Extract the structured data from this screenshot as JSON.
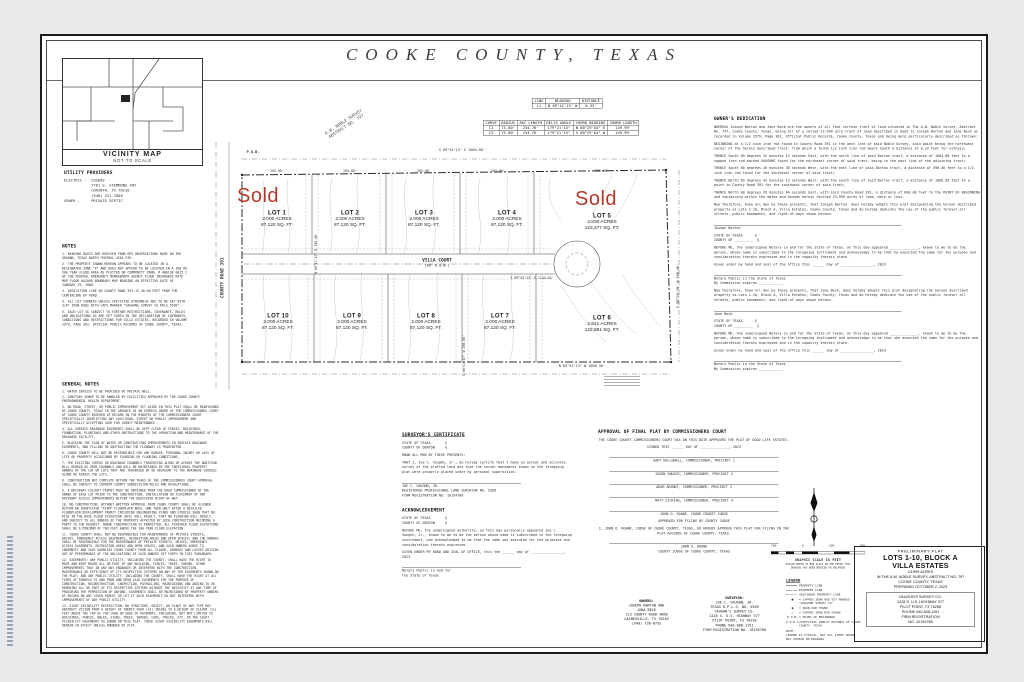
{
  "sheet": {
    "title": "COOKE  COUNTY,  TEXAS"
  },
  "vicinity": {
    "title": "VICINITY MAP",
    "subtitle": "NOT TO SCALE"
  },
  "utilities": {
    "title": "UTILITY PROVIDERS",
    "lines": [
      "ELECTRIC -  COSERV",
      "            7701 S. STEMMONS FWY",
      "            CORINTH, TX 76210",
      "            (940) 321-7800",
      "",
      "SEWER -     PRIVATE SEPTIC"
    ]
  },
  "notes": {
    "title": "NOTES",
    "items": [
      "1. BEARING BASIS ARE DERIVED FROM GPS OBSERVATIONS MADE ON THE GROUND, TEXAS NORTH CENTRAL 4202 RTK.",
      "2. THE PROPERTY SHOWN HEREON APPEARS TO BE LOCATED IN A DESIGNATED ZONE \"X\" AND DOES NOT APPEAR TO BE LOCATED IN A 100 OR 500 YEAR FLOOD AREA AS PLOTTED ON COMMUNITY PANEL # 480198 0025 C OF THE FEDERAL EMERGENCY MANAGEMENT AGENCY FLOOD INSURANCE RATE MAP FLOOD HAZARD BOUNDARY MAP BEARING AN EFFECTIVE DATE OF JANUARY 19, 2006.",
      "3. DEDICATION LINE ON COUNTY ROAD 391 IS 30.00 FEET FROM THE CENTERLINE OF ROAD.",
      "4. ALL LOT CORNERS UNLESS SPECIFIED OTHERWISE ARE TO BE SET WITH 3/8\" IRON RODS WITH CAPS MARKED \"VAUGHNS SURVEY CO RPLS 5509\".",
      "5. EACH LOT IS SUBJECT TO FURTHER RESTRICTIONS, COVENANTS, RULES AND OBLIGATIONS AS ARE SET FORTH IN THE DECLARATION OF COVENANTS, CONDITIONS AND RESTRICTIONS FOR VILLA ESTATES, RECORDED IN VOLUME 2979, PAGE 362, OFFICIAL PUBLIC RECORDS OF COOKE COUNTY, TEXAS."
    ]
  },
  "general_notes": {
    "title": "GENERAL NOTES",
    "items": [
      "1. WATER SERVICE TO BE PROVIDED BY PRIVATE WELL.",
      "2. SANITARY SEWER TO BE HANDLED BY FACILITIES APPROVED BY THE COOKE COUNTY ENVIRONMENTAL HEALTH DEPARTMENT.",
      "3. NO ROAD, STREET, OR PUBLIC IMPROVEMENT SET ASIDE IN THIS PLAT SHALL BE MAINTAINED BY COOKE COUNTY, TEXAS IN THE ABSENCE OF AN EXPRESS ORDER OF THE COMMISSIONERS COURT OF COOKE COUNTY ENTERED OF RECORD IN THE MINUTES OF THE COMMISSIONERS COURT SPECIFICALLY IDENTIFYING ANY SUCH ROAD, STREET OR PUBLIC IMPROVEMENT AND SPECIFICALLY ACCEPTING SUCH FOR COUNTY MAINTENANCE.",
      "4. ALL SURFACE DRAINAGE EASEMENTS SHALL BE KEPT CLEAR OF FENCES, BUILDINGS, FOUNDATION, PLANTINGS AND OTHER OBSTRUCTIONS TO THE OPERATION AND MAINTENANCE OF THE DRAINAGE FACILITY.",
      "5. BLOCKING THE FLOW OF WATER OR CONSTRUCTING IMPROVEMENTS IN SURFACE DRAINAGE EASEMENTS, AND FILLING OR OBSTRUCTING THE FLOODWAY IS PROHIBITED.",
      "6. COOKE COUNTY WILL NOT BE RESPONSIBLE FOR ANY DAMAGE, PERSONAL INJURY OR LOSS OF LIFE OR PROPERTY OCCASIONED BY FLOODING OR FLOODING CONDITIONS.",
      "7. THE EXISTING CREEKS OR DRAINAGE CHANNELS TRAVERSING ALONG OR ACROSS THE ADDITION WILL REMAIN AS OPEN CHANNELS AND WILL BE MAINTAINED BY THE INDIVIDUAL PROPERTY OWNERS OF THE LOT OR LOTS THAT ARE TRAVERSED BY OR ADJACENT TO THE DRAINAGE COURSES ALONG OR ACROSS THE LOTS.",
      "8. CONSTRUCTION NOT COMPLETE WITHIN TWO YEARS OF THE COMMISSIONERS COURT APPROVAL SHALL BE SUBJECT TO CURRENT COUNTY SUBDIVISION RULES AND REGULATIONS.",
      "9. A DRIVEWAY CULVERT PERMIT MUST BE OBTAINED FROM THE ROAD COMMISSIONER BY THE OWNER OF EACH LOT PRIOR TO THE CONSTRUCTION, INSTALLATION OR PLACEMENT OF ANY DRIVEWAY ACCESS IMPROVEMENTS WITHIN THE DEDICATED RIGHT-OF-WAY.",
      "10. NO CONSTRUCTION, WITHOUT WRITTEN APPROVAL FROM COOKE COUNTY SHALL BE ALLOWED WITHIN AN IDENTIFIED \"FIRM\" FLOODPLAIN AREA, AND THEN ONLY AFTER A DETAILED FLOODPLAIN DEVELOPMENT PERMIT INCLUDING ENGINEERING PLANS AND STUDIES SHOW THAT NO RISE IN THE BASE FLOOD ELEVATION (BFE) WILL RESULT, THAT NO FLOODING WILL RESULT, AND SUBJECT TO ALL OWNERS OF THE PROPERTY AFFECTED BY SUCH CONSTRUCTION BECOMING A PARTY TO THE REQUEST. WHERE CONSTRUCTION IS PERMITTED, ALL FINISHED FLOOR ELEVATIONS SHALL BE A MINIMUM OF TWO FEET ABOVE THE 100-YEAR FLOOD ELEVATION.",
      "11. COOKE COUNTY SHALL NOT BE RESPONSIBLE FOR MAINTENANCE OF PRIVATE STREETS, DRIVES, EMERGENCY ACCESS EASEMENTS, RECREATION AREAS AND OPEN SPACES; AND THE OWNERS SHALL BE RESPONSIBLE FOR THE MAINTENANCE OF PRIVATE STREETS, DRIVES, EMERGENCY ACCESS EASEMENTS, RECREATION AREAS AND OPEN SPACES, AND SAID OWNERS AGREE TO INDEMNIFY AND SAVE HARMLESS COOKE COUNTY FROM ALL CLAIMS, DAMAGES AND LOSSES ARISING OUT OF PERFORMANCE OF THE OBLIGATIONS OF SAID OWNERS SET FORTH IN THIS PARAGRAPH.",
      "12. EASEMENTS: ANY PUBLIC UTILITY, INCLUDING THE COUNTY, SHALL HAVE THE RIGHT TO MOVE AND KEEP MOVED ALL OR PART OF ANY BUILDING, FENCES, TREES, SHRUBS, OTHER IMPROVEMENTS THAT IN ANY WAY ENDANGER OR INTERFERE WITH THE CONSTRUCTION, MAINTENANCE OR EFFICIENCY OF ITS RESPECTIVE SYSTEMS ON ANY OF THE EASEMENTS SHOWN ON THE PLAT; AND ANY PUBLIC UTILITY, INCLUDING THE COUNTY, SHALL HAVE THE RIGHT AT ALL TIMES OF INGRESS TO AND FROM AND UPON SAID EASEMENTS FOR THE PURPOSE OF CONSTRUCTION, RECONSTRUCTION, INSPECTION, PATROLLING, MAINTAINING AND ADDING TO OR REMOVING ALL OR PART OF ITS RESPECTIVE SYSTEMS WITHOUT THE NECESSITY AT ANY TIME OF PROCURING THE PERMISSION OF ANYONE. EASEMENTS SHALL BE MAINTAINED BY PROPERTY OWNERS OF RECORD ON ANY GIVEN PARCEL OR LOT IF SUCH EASEMENTS DO NOT INTERFERE WITH IMPROVEMENTS OF ANY PUBLIC UTILITY.",
      "13. SIGHT VISIBILITY RESTRICTION: NO STRUCTURE, OBJECT, OR PLANT OF ANY TYPE MAY OBSTRUCT VISION FROM A HEIGHT OF TWENTY-FOUR (24) INCHES TO A HEIGHT OF ELEVEN (11) FEET ABOVE THE TOP OF THE CURB OR EDGE OF PAVEMENT, INCLUDING, BUT NOT LIMITED TO BUILDINGS, FENCES, WALKS, SIGNS, TREES, SHRUBS, CARS, TRUCKS, ETC. IN THE SIGHT VISIBILITY EASEMENTS AS SHOWN ON THIS PLAT. THESE SIGHT VISIBILITY EASEMENTS WILL REMAIN IN EFFECT UNLESS AMENDED BY PLAT."
    ]
  },
  "plat": {
    "sold_label": "Sold",
    "road_name": "VILLA COURT",
    "road_row": "(60' R.O.W.)",
    "county_road": "COUNTY ROAD 391",
    "survey_line1": "A.W. NOBLE SURVEY",
    "survey_line2": "ABSTRACT NO. 797",
    "pob_label": "P.O.B.",
    "north_bearing": "S 89°42'13\" E   1064.00'",
    "south_bearing": "N 89°42'13\" W   1060.50'",
    "east_bearing": "S 00°26'38\" W   598.46'",
    "center_bearing": "S 89°42'13\" E   1144.04'",
    "div_label_1": "N 00°17'47\" E   290.00'",
    "div_label_2": "S 00°17'47\" W   290.00'",
    "seg_labels": [
      "265.00'",
      "265.00'",
      "265.00'",
      "265.00'",
      "295.00'"
    ],
    "lots": [
      {
        "name": "LOT 1",
        "acres": "2.000 ACRES",
        "sqft": "87,120 SQ. FT.",
        "sold": true
      },
      {
        "name": "LOT 2",
        "acres": "2.000 ACRES",
        "sqft": "87,120 SQ. FT.",
        "sold": false
      },
      {
        "name": "LOT 3",
        "acres": "2.000 ACRES",
        "sqft": "87,120 SQ. FT.",
        "sold": false
      },
      {
        "name": "LOT 4",
        "acres": "2.000 ACRES",
        "sqft": "87,120 SQ. FT.",
        "sold": false
      },
      {
        "name": "LOT 5",
        "acres": "2.830 ACRES",
        "sqft": "123,277 SQ. FT.",
        "sold": true
      },
      {
        "name": "LOT 6",
        "acres": "2.821 ACRES",
        "sqft": "122,881 SQ. FT.",
        "sold": false
      },
      {
        "name": "LOT 7",
        "acres": "2.000 ACRES",
        "sqft": "87,120 SQ. FT.",
        "sold": false
      },
      {
        "name": "LOT 8",
        "acres": "2.000 ACRES",
        "sqft": "87,120 SQ. FT.",
        "sold": false
      },
      {
        "name": "LOT 9",
        "acres": "2.000 ACRES",
        "sqft": "87,120 SQ. FT.",
        "sold": false
      },
      {
        "name": "LOT 10",
        "acres": "2.000 ACRES",
        "sqft": "87,120 SQ. FT.",
        "sold": false
      }
    ]
  },
  "line_table": {
    "headers": [
      "LINE",
      "BEARING",
      "DISTANCE"
    ],
    "rows": [
      [
        "L1",
        "N 89°42'13\" W",
        "0.33'"
      ]
    ]
  },
  "curve_table": {
    "headers": [
      "CURVE",
      "RADIUS",
      "ARC LENGTH",
      "DELTA ANGLE",
      "CHORD BEARING",
      "CHORD LENGTH"
    ],
    "rows": [
      [
        "C1",
        "75.00'",
        "234.76'",
        "179°21'15\"",
        "N 00°29'04\" E",
        "149.99'"
      ],
      [
        "C2",
        "75.00'",
        "234.76'",
        "179°21'15\"",
        "S 00°29'04\" W",
        "149.99'"
      ]
    ]
  },
  "dedication": {
    "title": "OWNER'S DEDICATION",
    "blocks": [
      {
        "kind": "p",
        "text": "WHEREAS Joseph Barton and Jane Beck are the owners of all that certain tract of land situated in The A.W. Noble Survey, Abstract No. 797, Cooke County, Texas, being all of a called 23.999 acre tract of land described in deed to Joseph Barton and Jane Beck as recorded in Volume 2979, Page 362, Official Public Records, Cooke County, Texas and being more particularly described as follows:"
      },
      {
        "kind": "p",
        "text": "BEGINNING at a 1/2 inch iron rod found in County Road 391 in the west line of said Noble Survey, said point being the northwest corner of the herein described tract, from which a found 1/2 inch iron rod bears South a distance of 0.33 feet for witness;"
      },
      {
        "kind": "p",
        "text": "THENCE South 89 degrees 42 minutes 13 seconds East, with the north line of said Barton tract, a distance of 1064.00 feet to a capped iron rod marked VAUGHNS found for the northeast corner of said tract, being in the west line of the adjoining tract;"
      },
      {
        "kind": "p",
        "text": "THENCE South 00 degrees 26 minutes 38 seconds West, with the east line of said Barton tract, a distance of 598.46 feet to a 1/2 inch iron rod found for the southeast corner of said tract;"
      },
      {
        "kind": "p",
        "text": "THENCE North 89 degrees 42 minutes 13 seconds West, with the south line of said Barton tract, a distance of 1060.50 feet to a point in County Road 391 for the southwest corner of said tract;"
      },
      {
        "kind": "p",
        "text": "THENCE North 00 degrees 29 minutes 04 seconds East, with said County Road 391, a distance of 600.00 feet to the POINT OF BEGINNING and containing within the metes and bounds herein recited 23.999 acres of land, more or less."
      },
      {
        "kind": "p",
        "text": "Now therefore, know all men by these presents, that Joseph Barton, does hereby adopts this plat designating the hereon described property as Lots 1-10, Block A, Villa Estates, Cooke County, Texas and do hereby dedicate the use of the public forever all streets, public easements, and right-of-ways shown hereon."
      },
      {
        "kind": "sig",
        "text": "Joseph Barton"
      },
      {
        "kind": "state",
        "text": "STATE OF TEXAS      §\nCOUNTY OF _________  §"
      },
      {
        "kind": "p",
        "text": "BEFORE ME, the undersigned Notary in and for the State of Texas, on this day appeared ______________, known to me to be the person, whose name is subscribed to the foregoing instrument and acknowledge to me that he executed the same for the purpose and consideration therein expressed and in the capacity therein state."
      },
      {
        "kind": "p",
        "text": "Given under my hand and seal of the office this ______ day of ________________, 2023"
      },
      {
        "kind": "sig",
        "text": "Notary Public in the State of Texas\nMy Commission expires ____________"
      },
      {
        "kind": "p",
        "text": "Now therefore, know all men by these presents, that Jane Beck, does hereby adopts this plat designating the hereon described property as Lots 1-10, Block A, Villa Estates, Cooke County, Texas and do hereby dedicate the use of the public forever all streets, public easements, and right-of-ways shown hereon."
      },
      {
        "kind": "sig",
        "text": "Jane Beck"
      },
      {
        "kind": "state",
        "text": "STATE OF TEXAS      §\nCOUNTY OF _________  §"
      },
      {
        "kind": "p",
        "text": "BEFORE ME, the undersigned Notary in and for the State of Texas, on this day appeared ______________, known to me to be the person, whose name is subscribed to the foregoing instrument and acknowledge to me that she executed the same for the purpose and consideration therein expressed and in the capacity therein state."
      },
      {
        "kind": "p",
        "text": "Given under my hand and seal of the office this ______ day of ________________, 2023"
      },
      {
        "kind": "sig",
        "text": "Notary Public in the State of Texas\nMy Commission expires ____________"
      }
    ]
  },
  "surveyor_cert": {
    "title": "SURVEYOR'S CERTIFICATE",
    "blocks": [
      {
        "kind": "state",
        "text": "STATE OF TEXAS       §\nCOUNTY OF DENTON     §"
      },
      {
        "kind": "p",
        "text": "KNOW ALL MEN BY THESE PRESENTS:"
      },
      {
        "kind": "p",
        "text": "THAT I, Joe C. Vaughn, Jr., do hereby certify that I made an actual and accurate survey of the platted land and that the corner monuments shown on the foregoing plat were properly placed under my personal supervision."
      },
      {
        "kind": "sig",
        "text": "JOE C. VAUGHN, JR.\nREGISTERED PROFESSIONAL LAND SURVEYOR NO. 5509\nFIRM REGISTRATION NO. 10194786"
      }
    ]
  },
  "acknowledgement": {
    "title": "ACKNOWLEDGEMENT",
    "blocks": [
      {
        "kind": "state",
        "text": "STATE OF TEXAS       §\nCOUNTY OF DENTON     §"
      },
      {
        "kind": "p",
        "text": "BEFORE ME, the undersigned authority, on this day personally appeared Joe C. Vaughn, Jr., known to me to be the person whose name is subscribed to the foregoing instrument, who acknowledged to me that the same was executed for the purposes and consideration therein expressed."
      },
      {
        "kind": "p",
        "text": "GIVEN UNDER MY HAND AND SEAL OF OFFICE, this the ______ day of ________________, 2023"
      },
      {
        "kind": "sig",
        "text": "Notary Public in and for\nthe State of Texas"
      }
    ]
  },
  "approval": {
    "title": "APPROVAL OF FINAL PLAT BY COMMISSIONERS COURT",
    "blocks": [
      {
        "kind": "p",
        "text": "THE COOKE COUNTY COMMISSIONERS COURT HAS ON THIS DATE APPROVED THE PLAT OF GOOD LIFE ESTATES."
      },
      {
        "kind": "p",
        "text": "SIGNED THIS ______ DAY OF ______________, 2023"
      },
      {
        "kind": "sig",
        "text": "GARY HOLLOWELL, COMMISSIONER, PRECINCT 1"
      },
      {
        "kind": "sig",
        "text": "JASON SNUGGS, COMMISSIONER, PRECINCT 2"
      },
      {
        "kind": "sig",
        "text": "ADAM ARENDT, COMMISSIONER, PRECINCT 3"
      },
      {
        "kind": "sig",
        "text": "MATT SICKING, COMMISSIONER, PRECINCT 4"
      },
      {
        "kind": "sig",
        "text": "JOHN O. ROANE, COOKE COUNTY JUDGE"
      },
      {
        "kind": "p",
        "text": "APPROVED FOR FILING BY COUNTY JUDGE"
      },
      {
        "kind": "p",
        "text": "I, JOHN O. ROANE, JUDGE OF COOKE COUNTY, TEXAS, DO HEREBY APPROVE THIS PLAT FOR FILING IN THE PLAT RECORDS OF COOKE COUNTY, TEXAS."
      },
      {
        "kind": "sig",
        "text": "JOHN O. ROANE\nCOUNTY JUDGE OF COOKE COUNTY, TEXAS"
      }
    ]
  },
  "scale": {
    "ticks": [
      "100",
      "0",
      "100",
      "200"
    ],
    "label": "GRAPHIC SCALE IN FEET",
    "note": "PLEASE REFER TO BAR SCALE IN THE EVENT THIS\nDRAWING HAS BEEN REDUCED OR ENLARGED"
  },
  "legend": {
    "title": "LEGEND",
    "line_items": [
      {
        "kind": "solid",
        "text": "PROPERTY LINE"
      },
      {
        "kind": "dashed",
        "text": "EASEMENT LINE"
      },
      {
        "kind": "dashdot",
        "text": "ADJOINING PROPERTY LINE"
      }
    ],
    "symbol_items": [
      {
        "glyph": "■",
        "text": "= CAPPED IRON ROD SET MARKED \"VAUGHNS SURVEY CO\""
      },
      {
        "glyph": "●",
        "text": "= IRON ROD FOUND"
      },
      {
        "glyph": "○",
        "text": "= CAPPED IRON ROD FOUND"
      },
      {
        "glyph": "P.O.B.",
        "text": "= POINT OF BEGINNING"
      },
      {
        "glyph": "O.P.R.C.T.",
        "text": "= OFFICIAL PUBLIC RECORDS OF COOKE COUNTY, TEXAS"
      }
    ],
    "note": "NOTE:\nLEGEND IS TYPICAL, NOT ALL ITEMS SHOWN\nMAY APPEAR ON DRAWING"
  },
  "contacts": {
    "owners": {
      "title": "OWNERS:",
      "lines": [
        "JOSEPH BARTON AND",
        "JANA BECK",
        "113 COUNTY ROAD 4868",
        "GAINESVILLE, TX 76240",
        "(940) 736-0792"
      ]
    },
    "surveyor": {
      "title": "SURVEYOR:",
      "lines": [
        "JOE C. VAUGHN, JR.",
        "TEXAS R.P.L.S. NO. 5509",
        "VAUGHN'S SURVEY CO.",
        "1228 S. U.S. HIGHWAY 377",
        "PILOT POINT, TX 76258",
        "PHONE 940-808-1151",
        "FIRM REGISTRATION NO. 10194786"
      ]
    }
  },
  "title_block": {
    "type": "PRELIMINARY PLAT",
    "line1": "LOTS 1-10, BLOCK A",
    "line2": "VILLA ESTATES",
    "acreage": "23.999 ACRES",
    "survey": "IN THE A.W. NOBLE SURVEY, ABSTRACT NO. 797",
    "county": "COOKE COUNTY, TEXAS",
    "prepared": "PREPARED OCTOBER 2, 2023",
    "firm": [
      "VAUGHN'S SURVEY CO.",
      "1228 S. U.S. HIGHWAY 377",
      "PILOT POINT, TX 76258",
      "PHONE 940-808-1151",
      "FIRM REGISTRATION",
      "NO. 10194786"
    ]
  }
}
